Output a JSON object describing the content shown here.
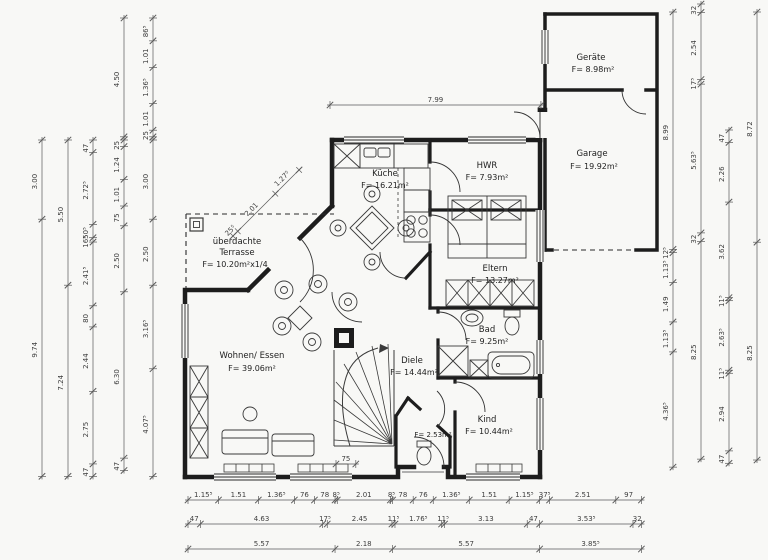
{
  "title": "Erdgeschoss Grundriss (floor plan)",
  "colors": {
    "paper": "#f8f8f6",
    "wall": "#1d1d1d",
    "dim_line": "#5a5a5a",
    "dim_text": "#3d3d3d"
  },
  "scale_px_per_m": 26.4,
  "rooms": {
    "geraete": {
      "name": "Geräte",
      "area": "F= 8.98m²"
    },
    "garage": {
      "name": "Garage",
      "area": "F= 19.92m²"
    },
    "kueche": {
      "name": "Küche",
      "area": "F= 16.21m²"
    },
    "hwr": {
      "name": "HWR",
      "area": "F= 7.93m²"
    },
    "eltern": {
      "name": "Eltern",
      "area": "F= 13.27m²"
    },
    "bad": {
      "name": "Bad",
      "area": "F= 9.25m²"
    },
    "diele": {
      "name": "Diele",
      "area": "F= 14.44m²"
    },
    "kind": {
      "name": "Kind",
      "area": "F= 10.44m²"
    },
    "wc": {
      "area": "F= 2.53m²"
    },
    "wohnen_essen": {
      "name": "Wohnen/ Essen",
      "area": "F= 39.06m²"
    },
    "terrasse": {
      "line1": "überdachte",
      "line2": "Terrasse",
      "area": "F= 10.20m²x1/4"
    }
  },
  "dimension_chains": [
    {
      "id": "left-1",
      "dir": "down",
      "x": 42,
      "y": 140,
      "values": [
        "3.00",
        "9.74"
      ]
    },
    {
      "id": "left-2",
      "dir": "down",
      "x": 68,
      "y": 140,
      "values": [
        "5.50",
        "7.24"
      ]
    },
    {
      "id": "left-3",
      "dir": "down",
      "x": 93,
      "y": 140,
      "values": [
        "47",
        "2.72⁵",
        "50⁵",
        "16⁵",
        "2.41⁵",
        "80",
        "2.44",
        "2.75",
        "47"
      ]
    },
    {
      "id": "left-4-top",
      "dir": "down",
      "x": 124,
      "y": 18,
      "values": [
        "4.50"
      ]
    },
    {
      "id": "left-4",
      "dir": "down",
      "x": 124,
      "y": 140,
      "values": [
        "25",
        "1.24",
        "1.01",
        "75",
        "2.50",
        "6.30",
        "47"
      ]
    },
    {
      "id": "left-5-top",
      "dir": "down",
      "x": 153,
      "y": 18,
      "values": [
        "86⁵",
        "1.01",
        "1.36⁵",
        "1.01",
        "25"
      ]
    },
    {
      "id": "left-5",
      "dir": "down",
      "x": 153,
      "y": 140,
      "values": [
        "3.00",
        "2.50",
        "3.16⁵",
        "4.07⁵"
      ]
    },
    {
      "id": "top-width",
      "dir": "right",
      "x": 330,
      "y": 105,
      "values": [
        "7.99"
      ]
    },
    {
      "id": "terrace-diagonal",
      "dir": "upright",
      "x": 233,
      "y": 236,
      "values": [
        "25⁵",
        "2.01",
        "1.27⁵"
      ]
    },
    {
      "id": "right-1",
      "dir": "down",
      "x": 673,
      "y": 12,
      "values": [
        "8.99",
        "12⁵",
        "1.13⁵",
        "1.49",
        "1.13⁵",
        "4.36⁵"
      ]
    },
    {
      "id": "right-2",
      "dir": "down",
      "x": 701,
      "y": 4,
      "values": [
        "32",
        "2.54",
        "17⁵",
        "5.63⁵",
        "32",
        "8.25"
      ]
    },
    {
      "id": "right-3",
      "dir": "down",
      "x": 729,
      "y": 130,
      "values": [
        "47",
        "2.26",
        "3.62",
        "11⁵",
        "2.63⁵",
        "11⁵",
        "2.94",
        "47"
      ]
    },
    {
      "id": "right-4",
      "dir": "down",
      "x": 757,
      "y": 12,
      "values": [
        "8.72",
        "8.25"
      ]
    },
    {
      "id": "bottom-1",
      "dir": "right",
      "x": 188,
      "y": 500,
      "values": [
        "1.15⁵",
        "1.51",
        "1.36⁵",
        "76",
        "78",
        "8⁵",
        "2.01",
        "8⁵",
        "78",
        "76",
        "1.36⁵",
        "1.51",
        "1.15⁵",
        "37⁵",
        "2.51",
        "97"
      ]
    },
    {
      "id": "bottom-2",
      "dir": "right",
      "x": 188,
      "y": 524,
      "values": [
        "47",
        "4.63",
        "17⁵",
        "2.45",
        "11⁵",
        "1.76⁵",
        "11⁵",
        "3.13",
        "47",
        "3.53⁵",
        "32"
      ]
    },
    {
      "id": "bottom-3",
      "dir": "right",
      "x": 188,
      "y": 549,
      "values": [
        "5.57",
        "2.18",
        "5.57",
        "3.85⁵"
      ]
    },
    {
      "id": "entry-width",
      "dir": "right",
      "x": 336,
      "y": 464,
      "values": [
        "75"
      ]
    }
  ]
}
